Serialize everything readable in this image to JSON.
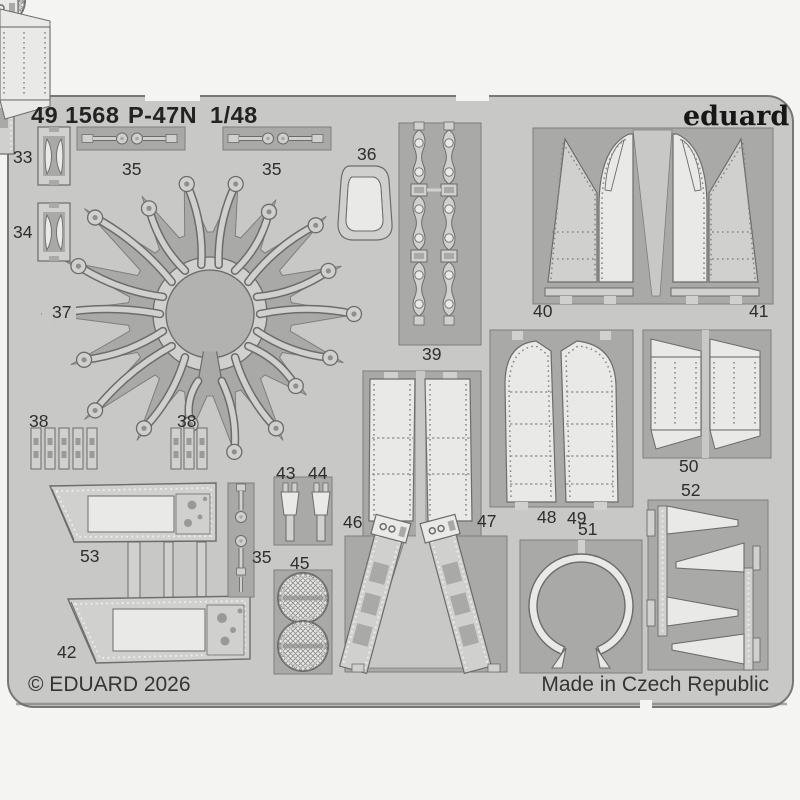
{
  "header": {
    "catalog_number": "49 1568",
    "product_name": "P-47N",
    "scale": "1/48",
    "brand": "eduard"
  },
  "footer": {
    "copyright": "© EDUARD 2026",
    "origin": "Made in Czech Republic"
  },
  "part_labels": [
    "33",
    "34",
    "35",
    "35",
    "36",
    "37",
    "38",
    "38",
    "39",
    "40",
    "41",
    "42",
    "43",
    "44",
    "45",
    "35",
    "46",
    "47",
    "48",
    "49",
    "50",
    "51",
    "52",
    "53"
  ],
  "colors": {
    "page_bg": "#f4f4f2",
    "sheet": "#c8c8c6",
    "recess": "#a9a9a7",
    "recess_stroke": "#7e7e7c",
    "part": "#d0d0ce",
    "part_bright": "#e9e9e7",
    "outline": "#6c6c6a",
    "rivet": "#8f8f8d",
    "text": "#2e2e2e"
  }
}
